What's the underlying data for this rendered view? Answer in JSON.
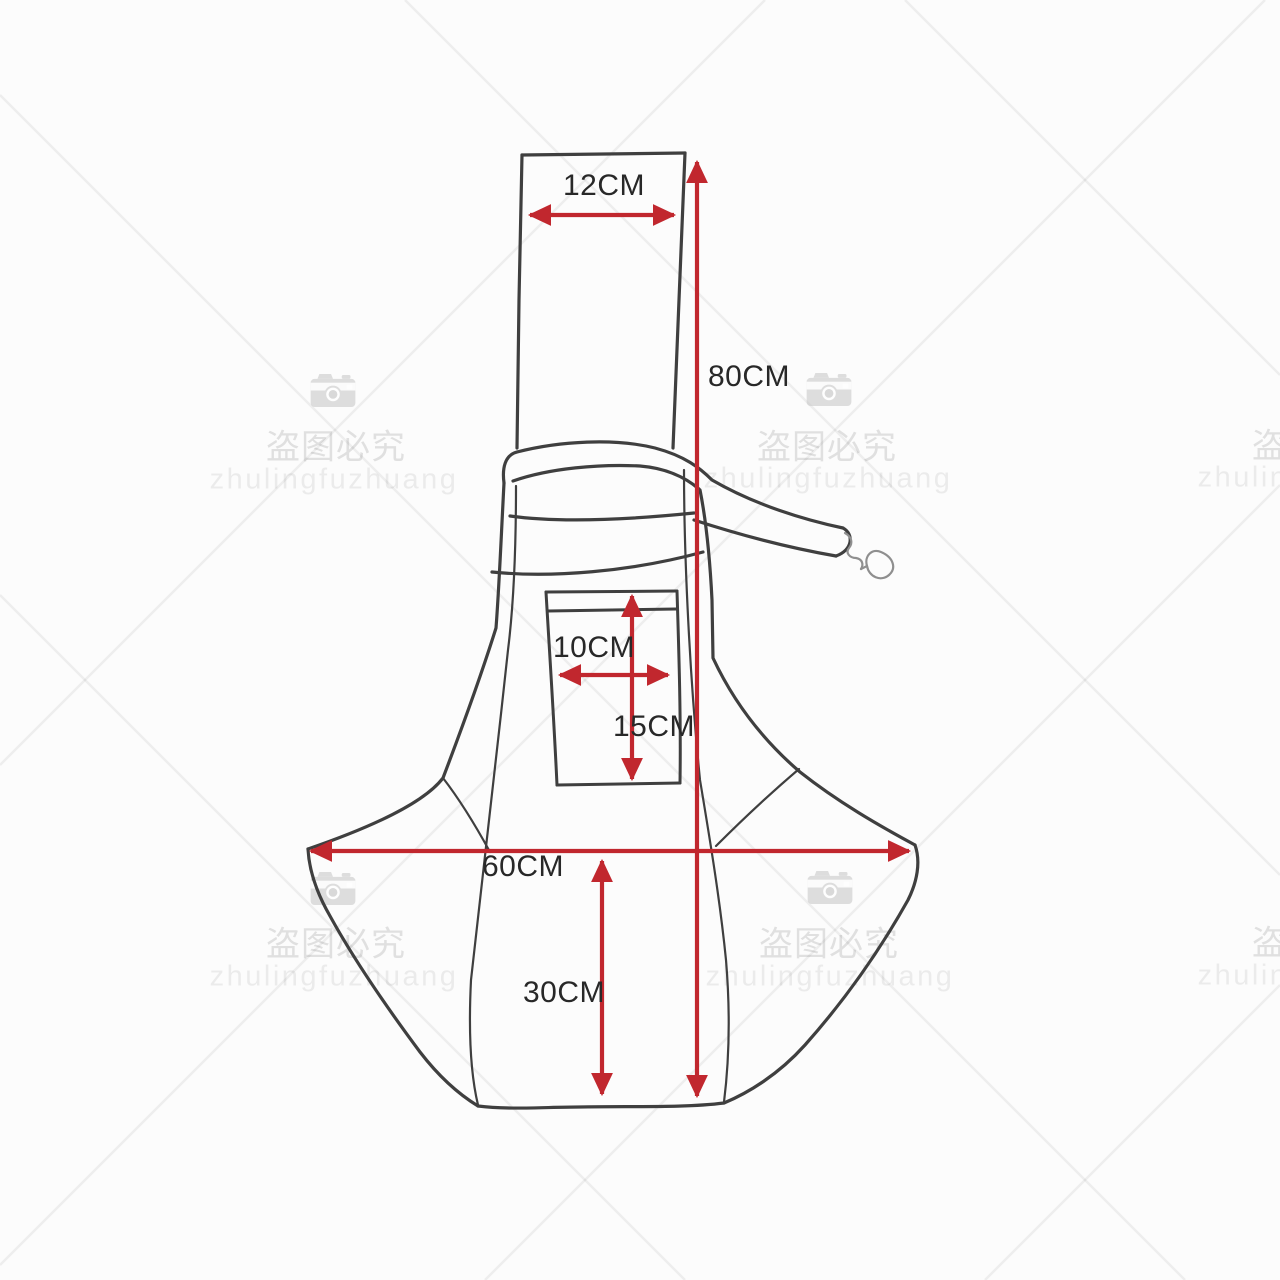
{
  "diagram_type": "product-dimension-sketch",
  "dims": {
    "top_strap_width": {
      "label": "12CM"
    },
    "total_height": {
      "label": "80CM"
    },
    "pocket_width": {
      "label": "10CM"
    },
    "pocket_height": {
      "label": "15CM"
    },
    "bottom_width": {
      "label": "60CM"
    },
    "bottom_depth": {
      "label": "30CM"
    }
  },
  "watermark": {
    "cn": "盗图必究",
    "latin": "zhulingfuzhuang"
  },
  "colors": {
    "dimension_red": "#c1272e",
    "sketch_line": "#3f3f3f",
    "label_text": "#282828",
    "watermark_gray": "#dedede",
    "background": "#fcfcfc"
  }
}
